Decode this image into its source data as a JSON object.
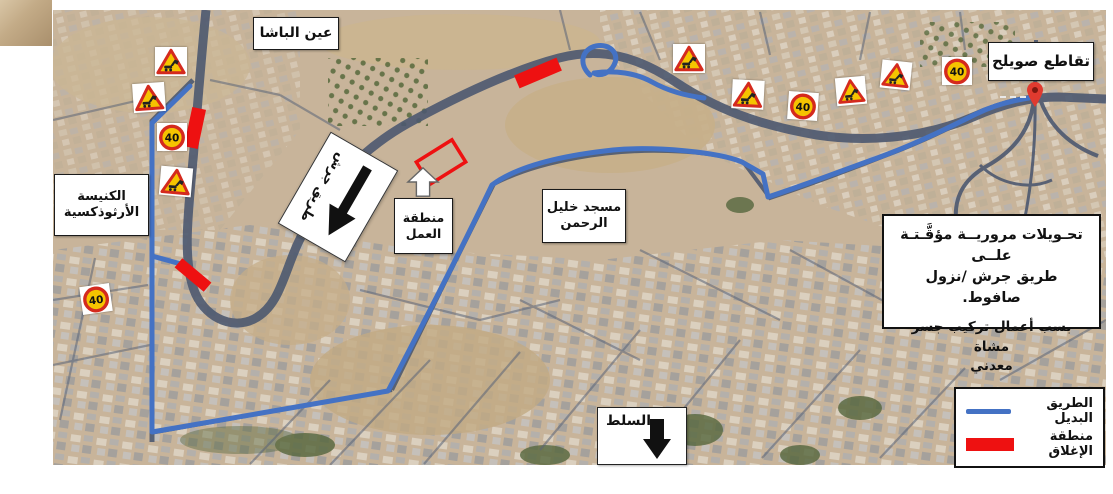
{
  "labels": {
    "ain_al_basha": "عين الباشا",
    "suweileh_intersection": "تقاطع صويلح",
    "orthodox_church_line1": "الكنيسة",
    "orthodox_church_line2": "الأرثوذكسية",
    "mosque_line1": "مسجد خليل",
    "mosque_line2": "الرحمن",
    "work_zone_line1": "منطقة",
    "work_zone_line2": "العمل",
    "salt": "السلط",
    "jerash_road": "طريق جرش"
  },
  "info_box": {
    "line1": "تحـويلات مروريــة مؤقَّـتـة علــى",
    "line2": "طريق جرش /نزول صافوط.",
    "line3": "بسب أعمال تركيب جسر مشاة",
    "line4": "معدني"
  },
  "legend": {
    "alt_route_label": "الطريق البديل",
    "closure_label": "منطقة الإغلاق"
  },
  "signs": {
    "speed_limit": "40"
  },
  "colors": {
    "route_blue": "#4472c4",
    "closure_red": "#ee1111",
    "sign_yellow": "#f5c400",
    "sign_border_red": "#d42a1e"
  }
}
